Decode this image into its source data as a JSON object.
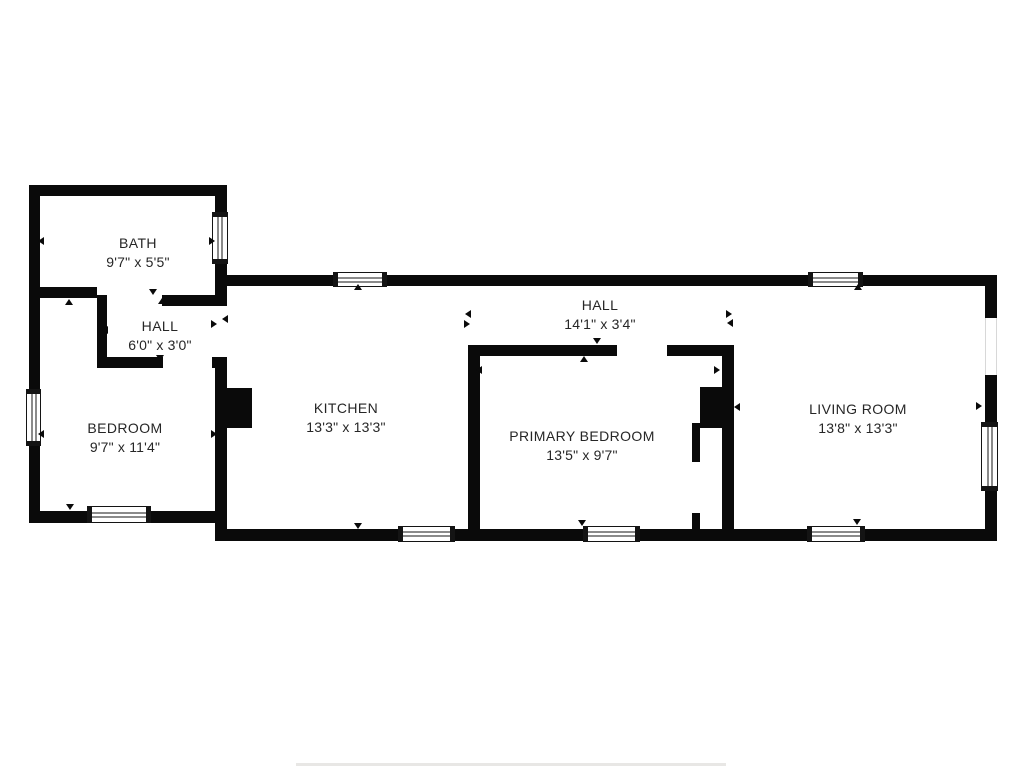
{
  "page": {
    "type": "floor-plan",
    "background_color": "#ffffff",
    "wall_color": "#0a0a0a",
    "text_color": "#262626"
  },
  "rooms": [
    {
      "id": "bath",
      "name": "BATH",
      "dims": "9'7\" x 5'5\""
    },
    {
      "id": "hall-small",
      "name": "HALL",
      "dims": "6'0\" x 3'0\""
    },
    {
      "id": "bedroom",
      "name": "BEDROOM",
      "dims": "9'7\" x 11'4\""
    },
    {
      "id": "kitchen",
      "name": "KITCHEN",
      "dims": "13'3\" x 13'3\""
    },
    {
      "id": "hall-main",
      "name": "HALL",
      "dims": "14'1\" x 3'4\""
    },
    {
      "id": "primary-bedroom",
      "name": "PRIMARY BEDROOM",
      "dims": "13'5\" x 9'7\""
    },
    {
      "id": "living-room",
      "name": "LIVING ROOM",
      "dims": "13'8\" x 13'3\""
    }
  ]
}
